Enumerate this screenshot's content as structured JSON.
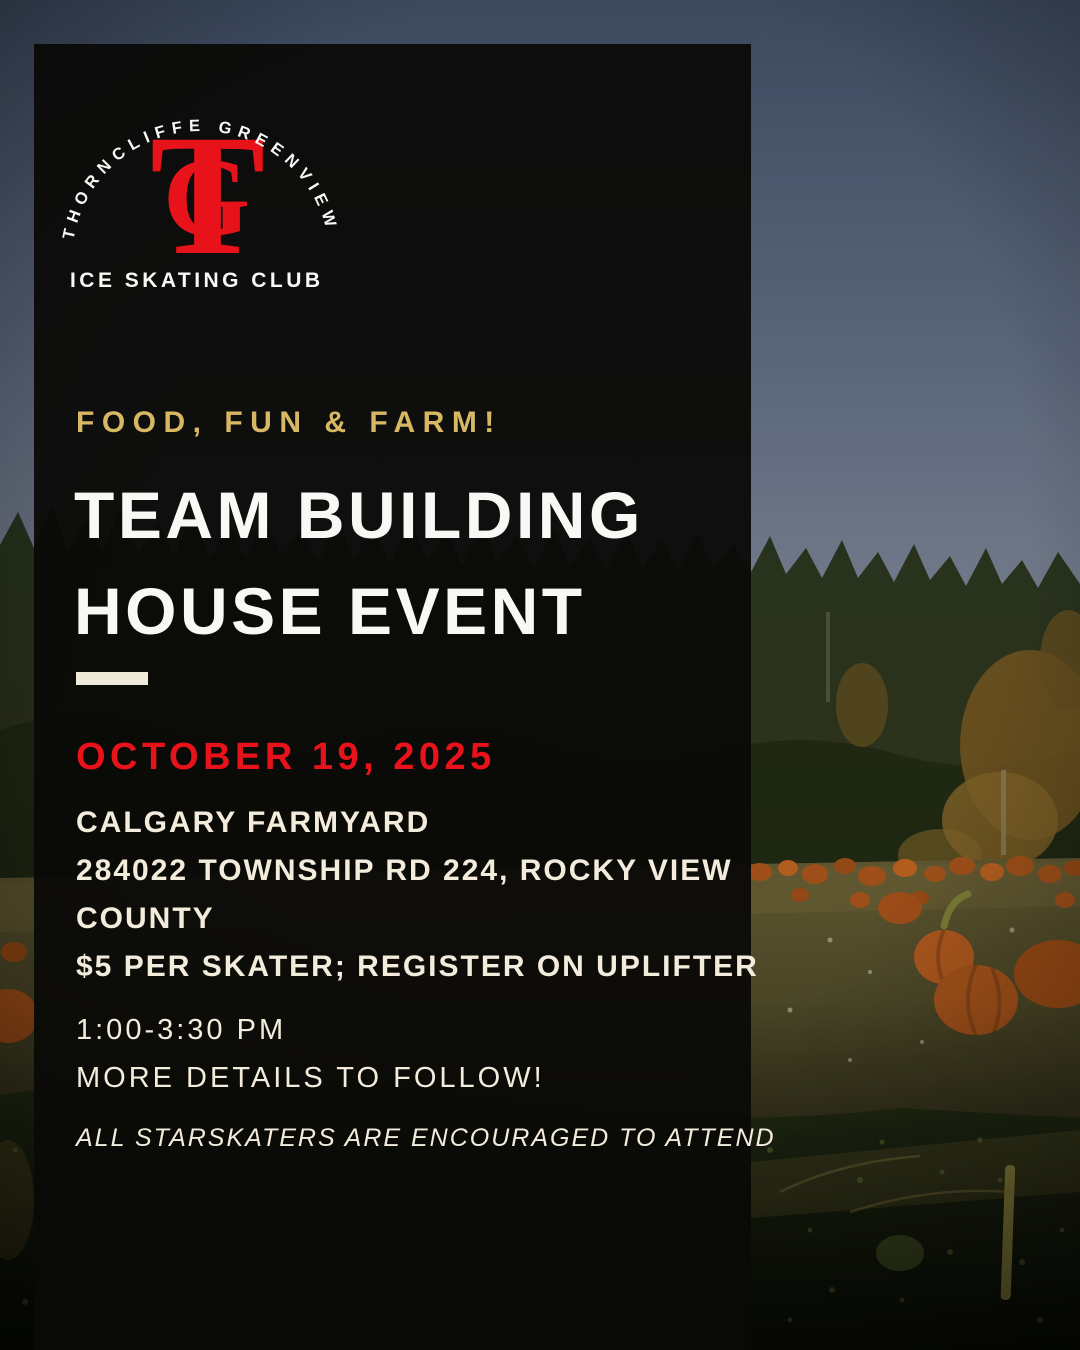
{
  "poster": {
    "logo": {
      "arc_text": "THORNCLIFFE GREENVIEW",
      "monogram_t": "T",
      "monogram_g": "G",
      "subtitle": "ICE SKATING CLUB"
    },
    "eyebrow": "FOOD, FUN & FARM!",
    "title_line1": "TEAM BUILDING",
    "title_line2": "HOUSE EVENT",
    "date": "OCTOBER 19, 2025",
    "details": [
      "CALGARY FARMYARD",
      "284022 TOWNSHIP RD 224, ROCKY VIEW",
      "COUNTY",
      "$5 PER SKATER; REGISTER ON UPLIFTER"
    ],
    "schedule": {
      "time": "1:00-3:30 PM",
      "note": "MORE DETAILS TO FOLLOW!"
    },
    "footnote": "ALL STARSKATERS ARE ENCOURAGED TO ATTEND",
    "colors": {
      "gold": "#d9b863",
      "red": "#e8131a",
      "white": "#f8f8f5",
      "cream": "#f3ecdc",
      "panel": "rgba(10,9,7,0.95)",
      "divider": "#efe9da",
      "sky_top": "#45546b",
      "sky_bottom": "#8d95a5",
      "tree_green": "#2c3a22",
      "golden_foliage": "#7a5c24",
      "field_olive": "#5f5931",
      "pumpkin_orange": "#bc5e1e",
      "foreground_green": "#273218"
    }
  }
}
